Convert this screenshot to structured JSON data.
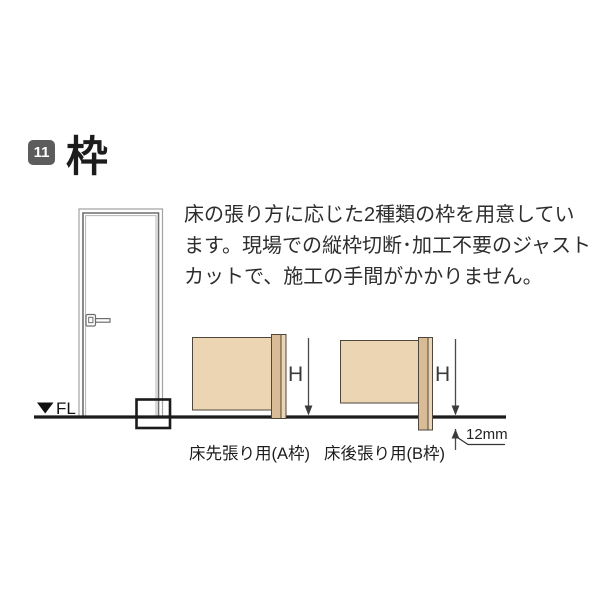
{
  "header": {
    "badge": "11",
    "title": "枠"
  },
  "description": {
    "line1": "床の張り方に応じた2種類の枠を用意してい",
    "line2": "ます。現場での縦枠切断･加工不要のジャスト",
    "line3": "カットで、施工の手間がかかりません。"
  },
  "door_figure": {
    "floor_level_label": "FL"
  },
  "diagrams": {
    "a": {
      "height_label": "H",
      "caption": "床先張り用(A枠)"
    },
    "b": {
      "height_label": "H",
      "caption": "床後張り用(B枠)",
      "offset_label": "12mm"
    }
  },
  "colors": {
    "wall_fill": "#ecd5b2",
    "frame_fill": "#d9bc95",
    "frame_light_fill": "#ead6b6",
    "badge_bg": "#5c5c5c",
    "floor_line": "#1b1b1b"
  }
}
